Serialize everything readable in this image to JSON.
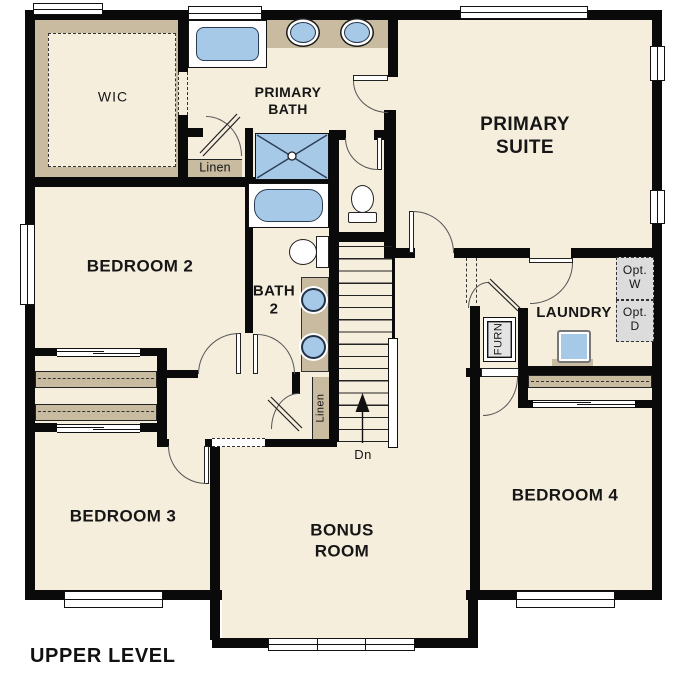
{
  "title": "UPPER LEVEL",
  "floor_plan": {
    "rooms": [
      {
        "id": "wic",
        "label": "WIC"
      },
      {
        "id": "primary-bath",
        "label": "PRIMARY\nBATH"
      },
      {
        "id": "primary-suite",
        "label": "PRIMARY\nSUITE"
      },
      {
        "id": "bedroom-2",
        "label": "BEDROOM 2"
      },
      {
        "id": "bath-2",
        "label": "BATH\n2"
      },
      {
        "id": "laundry",
        "label": "LAUNDRY"
      },
      {
        "id": "bedroom-3",
        "label": "BEDROOM 3"
      },
      {
        "id": "bonus-room",
        "label": "BONUS\nROOM"
      },
      {
        "id": "bedroom-4",
        "label": "BEDROOM 4"
      }
    ],
    "annotations": {
      "linen_upper": "Linen",
      "linen_hall": "Linen",
      "furnace": "FURN",
      "optional_washer": "Opt.\nW",
      "optional_dryer": "Opt.\nD",
      "stairs_direction": "Dn"
    },
    "fixtures": [
      "primary-bathtub",
      "primary-double-vanity",
      "shower",
      "water-closet-toilet",
      "bath2-tub",
      "bath2-toilet",
      "bath2-double-vanity",
      "laundry-sink-washer",
      "stairs",
      "closet-shelves"
    ],
    "colors": {
      "wall": "#0a0a0a",
      "floor": "#f6eedd",
      "casework_tan": "#c8bba0",
      "fixture_blue": "#a6c9e8",
      "optional_gray": "#dcdcdc",
      "window_white": "#ffffff"
    }
  }
}
